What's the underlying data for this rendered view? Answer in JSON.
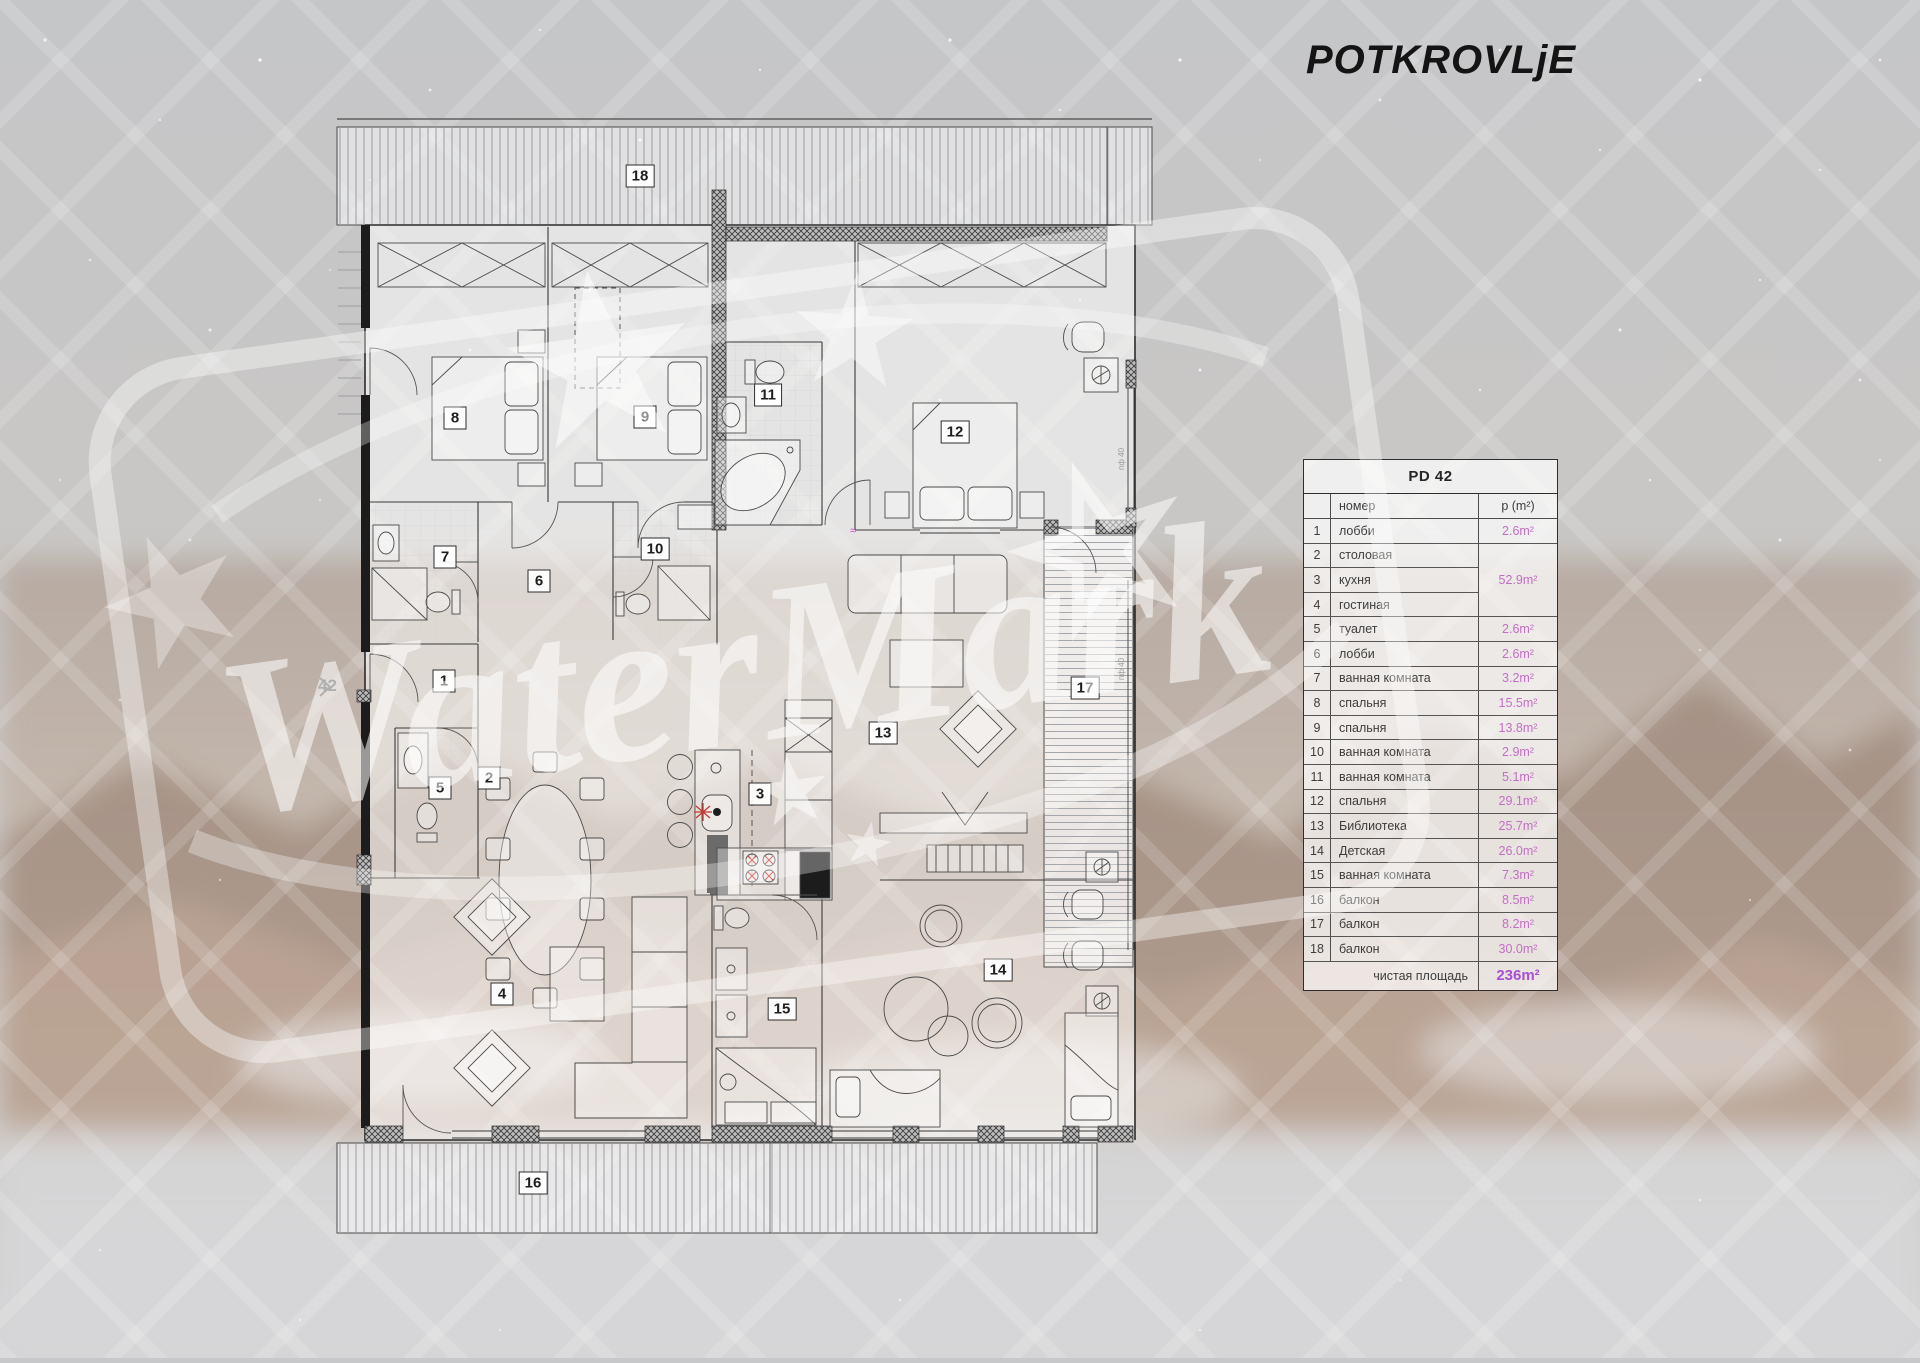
{
  "page": {
    "title": "POTKROVLjE"
  },
  "watermark": {
    "text": "WaterMark"
  },
  "entrance": {
    "number": "42"
  },
  "window_label": "пф 40",
  "marks": {
    "outlet": "≈"
  },
  "colors": {
    "area_value": "#c36ec5",
    "total_value": "#a84fd2",
    "table_text": "#3d3d3d",
    "title_text": "#141414",
    "red_accent": "#c03a30"
  },
  "table": {
    "title": "PD 42",
    "header": {
      "name": "номер",
      "area": "p (m²)"
    },
    "rows": [
      {
        "num": "1",
        "name": "лобби",
        "area": "2.6m²"
      },
      {
        "num": "2",
        "name": "столовая",
        "area": "",
        "merge": "top"
      },
      {
        "num": "3",
        "name": "кухня",
        "area": "52.9m²",
        "merge": "mid"
      },
      {
        "num": "4",
        "name": "гостиная",
        "area": "",
        "merge": "bottom"
      },
      {
        "num": "5",
        "name": "туалет",
        "area": "2.6m²"
      },
      {
        "num": "6",
        "name": "лобби",
        "area": "2.6m²"
      },
      {
        "num": "7",
        "name": "ванная комната",
        "area": "3.2m²"
      },
      {
        "num": "8",
        "name": "спальня",
        "area": "15.5m²"
      },
      {
        "num": "9",
        "name": "спальня",
        "area": "13.8m²"
      },
      {
        "num": "10",
        "name": "ванная комната",
        "area": "2.9m²"
      },
      {
        "num": "11",
        "name": "ванная комната",
        "area": "5.1m²"
      },
      {
        "num": "12",
        "name": "спальня",
        "area": "29.1m²"
      },
      {
        "num": "13",
        "name": "Библиотека",
        "area": "25.7m²"
      },
      {
        "num": "14",
        "name": "Детская",
        "area": "26.0m²"
      },
      {
        "num": "15",
        "name": "ванная комната",
        "area": "7.3m²"
      },
      {
        "num": "16",
        "name": "балкон",
        "area": "8.5m²"
      },
      {
        "num": "17",
        "name": "балкон",
        "area": "8.2m²"
      },
      {
        "num": "18",
        "name": "балкон",
        "area": "30.0m²"
      }
    ],
    "footer": {
      "label": "чистая площадь",
      "value": "236m²"
    }
  },
  "plan": {
    "room_labels": [
      {
        "n": "1",
        "x": 444,
        "y": 681
      },
      {
        "n": "2",
        "x": 489,
        "y": 778
      },
      {
        "n": "3",
        "x": 760,
        "y": 794
      },
      {
        "n": "4",
        "x": 502,
        "y": 994
      },
      {
        "n": "5",
        "x": 440,
        "y": 788
      },
      {
        "n": "6",
        "x": 539,
        "y": 581
      },
      {
        "n": "7",
        "x": 445,
        "y": 557
      },
      {
        "n": "8",
        "x": 455,
        "y": 418
      },
      {
        "n": "9",
        "x": 645,
        "y": 417
      },
      {
        "n": "10",
        "x": 655,
        "y": 549
      },
      {
        "n": "11",
        "x": 768,
        "y": 395
      },
      {
        "n": "12",
        "x": 955,
        "y": 432
      },
      {
        "n": "13",
        "x": 883,
        "y": 733
      },
      {
        "n": "14",
        "x": 998,
        "y": 970
      },
      {
        "n": "15",
        "x": 782,
        "y": 1009
      },
      {
        "n": "16",
        "x": 533,
        "y": 1183
      },
      {
        "n": "17",
        "x": 1085,
        "y": 688
      },
      {
        "n": "18",
        "x": 640,
        "y": 176
      }
    ]
  }
}
